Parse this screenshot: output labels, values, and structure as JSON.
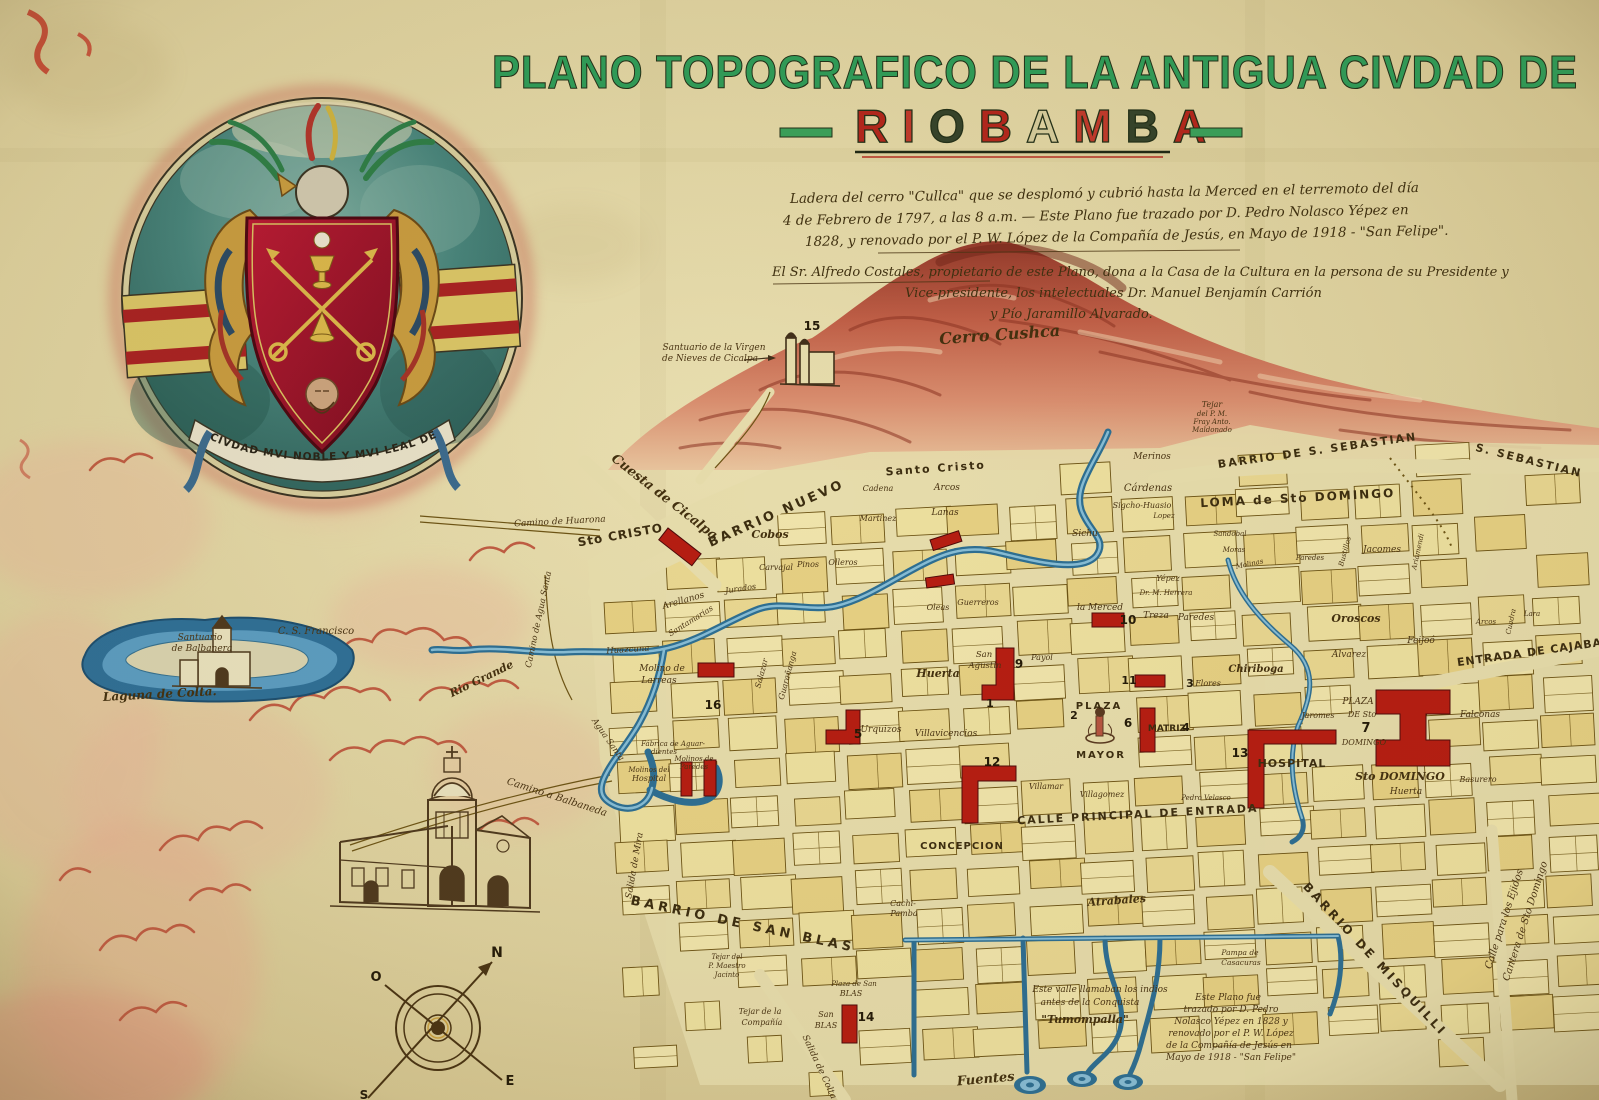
{
  "title": {
    "line1": "PLANO TOPOGRAFICO DE LA ANTIGUA CIVDAD DE",
    "line2": "RIOBAMBA",
    "letter_colors": [
      "#b3261c",
      "#c0392b",
      "#35432a",
      "#b3261c",
      "#d5cb9b",
      "#c0392b",
      "#35432a",
      "#b3261c"
    ],
    "accent_green": "#2f9c58",
    "accent_red": "#b3261c"
  },
  "coat_of_arms": {
    "motto": "CIVDAD MVI NOBLE Y MVI LEAL DE SAN PEDRO DE RIOBAMBA"
  },
  "compass": {
    "north": "N",
    "south": "S",
    "east": "E",
    "west": "O"
  },
  "map_labels": [
    {
      "t": "Ladera del cerro \"Cullca\" que se desplomó y cubrió hasta la Merced en el terremoto del día",
      "c": "note",
      "s": 13.5,
      "x": 790,
      "y": 203,
      "a": "start",
      "r": -1
    },
    {
      "t": "4 de Febrero de 1797, a las 8 a.m. — Este Plano fue trazado por D. Pedro Nolasco Yépez en",
      "c": "note",
      "s": 13.5,
      "x": 783,
      "y": 225,
      "a": "start",
      "r": -1
    },
    {
      "t": "1828, y renovado por el P. W. López de la Compañía de Jesús, en Mayo de 1918 - \"San Felipe\".",
      "c": "note",
      "s": 13.5,
      "x": 805,
      "y": 246,
      "a": "start",
      "r": -1
    },
    {
      "t": "El Sr. Alfredo Costales, propietario de este Plano, dona a la Casa de la Cultura en la persona de su Presidente y",
      "c": "note",
      "s": 13,
      "x": 772,
      "y": 276,
      "a": "start"
    },
    {
      "t": "Vice-presidente, los intelectuales Dr. Manuel Benjamín Carrión",
      "c": "note",
      "s": 13,
      "x": 905,
      "y": 297,
      "a": "start"
    },
    {
      "t": "y Pío Jaramillo Alvarado.",
      "c": "note",
      "s": 13,
      "x": 990,
      "y": 318,
      "a": "start"
    },
    {
      "t": "Cerro Cushca",
      "c": "scriptb",
      "s": 16,
      "x": 1000,
      "y": 340,
      "r": -4
    },
    {
      "t": "Santuario de la Virgen",
      "s": 9,
      "x": 714,
      "y": 350
    },
    {
      "t": "de Nieves de Cicalpa",
      "s": 9,
      "x": 710,
      "y": 361
    },
    {
      "t": "15",
      "c": "num",
      "s": 12,
      "x": 812,
      "y": 330
    },
    {
      "t": "Santuario",
      "s": 9,
      "x": 200,
      "y": 640
    },
    {
      "t": "de Balbanera",
      "s": 9,
      "x": 202,
      "y": 651
    },
    {
      "t": "C. S. Francisco",
      "s": 10,
      "x": 316,
      "y": 634
    },
    {
      "t": "Laguna de Colta.",
      "c": "scriptb",
      "s": 12,
      "x": 160,
      "y": 698,
      "r": -3
    },
    {
      "t": "Cuesta de Cicalpa",
      "c": "scriptb",
      "s": 13,
      "x": 662,
      "y": 500,
      "r": 38
    },
    {
      "t": "Camino de Huarona",
      "s": 9,
      "x": 560,
      "y": 524,
      "r": -3
    },
    {
      "t": "Sto CRISTO",
      "c": "caps",
      "s": 12,
      "x": 621,
      "y": 539,
      "r": -10,
      "sp": 1
    },
    {
      "t": "BARRIO NUEVO",
      "c": "caps",
      "s": 13,
      "x": 778,
      "y": 517,
      "r": -24,
      "sp": 3
    },
    {
      "t": "Santo Cristo",
      "c": "caps",
      "s": 11,
      "x": 936,
      "y": 472,
      "r": -4,
      "sp": 2
    },
    {
      "t": "BARRIO DE S. SEBASTIAN",
      "c": "caps",
      "s": 11,
      "x": 1318,
      "y": 454,
      "r": -8,
      "sp": 2
    },
    {
      "t": "S. SEBASTIAN",
      "c": "caps",
      "s": 11,
      "x": 1528,
      "y": 464,
      "r": 14,
      "sp": 2
    },
    {
      "t": "LOMA de Sto DOMINGO",
      "c": "caps",
      "s": 12,
      "x": 1298,
      "y": 502,
      "r": -3,
      "sp": 2
    },
    {
      "t": "ENTRADA DE CAJABA",
      "c": "caps",
      "s": 11,
      "x": 1530,
      "y": 656,
      "r": -8,
      "sp": 1
    },
    {
      "t": "CALLE PRINCIPAL DE ENTRADA",
      "c": "caps",
      "s": 11,
      "x": 1138,
      "y": 818,
      "r": -3,
      "sp": 2
    },
    {
      "t": "BARRIO DE SAN BLAS",
      "c": "caps",
      "s": 13,
      "x": 742,
      "y": 928,
      "r": 12,
      "sp": 4
    },
    {
      "t": "BARRIO DE MISQUILLI",
      "c": "caps",
      "s": 12,
      "x": 1372,
      "y": 962,
      "r": 47,
      "sp": 3
    },
    {
      "t": "Calle para los Ejidos",
      "s": 10,
      "x": 1507,
      "y": 920,
      "r": -72
    },
    {
      "t": "Cantera de Sto Domingo",
      "s": 10,
      "x": 1528,
      "y": 922,
      "r": -72
    },
    {
      "t": "Salida de Mira",
      "s": 9,
      "x": 637,
      "y": 866,
      "r": -80
    },
    {
      "t": "Salida de Colta",
      "s": 9,
      "x": 817,
      "y": 1068,
      "r": 65
    },
    {
      "t": "Camino a Balbaneda",
      "s": 10,
      "x": 556,
      "y": 800,
      "r": 18
    },
    {
      "t": "Camino de Agua Santa",
      "s": 8.5,
      "x": 541,
      "y": 620,
      "r": -78
    },
    {
      "t": "Agua Santa",
      "s": 8.5,
      "x": 606,
      "y": 741,
      "r": 55
    },
    {
      "t": "Rio Grande",
      "c": "scriptb",
      "s": 11,
      "x": 483,
      "y": 682,
      "r": -26
    },
    {
      "t": "Huazcuna",
      "s": 8.5,
      "x": 628,
      "y": 652,
      "r": -4
    },
    {
      "t": "Merinos",
      "s": 9,
      "x": 1152,
      "y": 459
    },
    {
      "t": "Cárdenas",
      "s": 10,
      "x": 1148,
      "y": 491
    },
    {
      "t": "Sigcho-Huasio",
      "s": 8,
      "x": 1142,
      "y": 508
    },
    {
      "t": "Sichu",
      "s": 9,
      "x": 1085,
      "y": 536
    },
    {
      "t": "Tejar",
      "s": 8,
      "x": 1212,
      "y": 407
    },
    {
      "t": "del P. M.",
      "s": 7,
      "x": 1212,
      "y": 416
    },
    {
      "t": "Fray Anto.",
      "s": 7,
      "x": 1212,
      "y": 424
    },
    {
      "t": "Maldonado",
      "s": 7,
      "x": 1212,
      "y": 432
    },
    {
      "t": "Lopez",
      "s": 7,
      "x": 1164,
      "y": 518
    },
    {
      "t": "Sandobal",
      "s": 7,
      "x": 1230,
      "y": 536
    },
    {
      "t": "Moras",
      "s": 7,
      "x": 1234,
      "y": 552
    },
    {
      "t": "Molinas",
      "s": 7,
      "x": 1250,
      "y": 566,
      "r": -12
    },
    {
      "t": "Paredes",
      "s": 7,
      "x": 1310,
      "y": 560
    },
    {
      "t": "Bustillos",
      "s": 7,
      "x": 1347,
      "y": 552,
      "r": -75
    },
    {
      "t": "Jacomes",
      "s": 9,
      "x": 1382,
      "y": 552
    },
    {
      "t": "Ariamendi",
      "s": 7,
      "x": 1420,
      "y": 552,
      "r": -78
    },
    {
      "t": "Oroscos",
      "c": "scriptb",
      "s": 11,
      "x": 1356,
      "y": 622
    },
    {
      "t": "Alvarez",
      "s": 9,
      "x": 1349,
      "y": 657
    },
    {
      "t": "Feijoó",
      "s": 9,
      "x": 1421,
      "y": 643
    },
    {
      "t": "Arcos",
      "s": 7,
      "x": 1486,
      "y": 624
    },
    {
      "t": "Cuadra",
      "s": 7,
      "x": 1513,
      "y": 622,
      "r": -78
    },
    {
      "t": "Lara",
      "s": 7,
      "x": 1532,
      "y": 616
    },
    {
      "t": "Falconas",
      "s": 9,
      "x": 1480,
      "y": 717
    },
    {
      "t": "PLAZA",
      "c": "caps",
      "s": 10,
      "x": 1099,
      "y": 709,
      "sp": 2
    },
    {
      "t": "MAYOR",
      "c": "caps",
      "s": 10,
      "x": 1101,
      "y": 758,
      "sp": 2
    },
    {
      "t": "MATRIZ",
      "c": "caps",
      "s": 9,
      "x": 1167,
      "y": 731
    },
    {
      "t": "4",
      "c": "num",
      "s": 11,
      "x": 1186,
      "y": 731
    },
    {
      "t": "6",
      "c": "num",
      "s": 12,
      "x": 1128,
      "y": 727
    },
    {
      "t": "1",
      "c": "num",
      "s": 11,
      "x": 990,
      "y": 707
    },
    {
      "t": "2",
      "c": "num",
      "s": 11,
      "x": 1074,
      "y": 719
    },
    {
      "t": "San",
      "s": 8.5,
      "x": 984,
      "y": 657
    },
    {
      "t": "Agustin",
      "s": 8.5,
      "x": 985,
      "y": 668
    },
    {
      "t": "9",
      "c": "num",
      "s": 12,
      "x": 1019,
      "y": 668
    },
    {
      "t": "Huerta",
      "c": "scriptb",
      "s": 11,
      "x": 938,
      "y": 677
    },
    {
      "t": "la Merced",
      "s": 9,
      "x": 1100,
      "y": 610
    },
    {
      "t": "10",
      "c": "num",
      "s": 12,
      "x": 1128,
      "y": 624
    },
    {
      "t": "Treza",
      "s": 9,
      "x": 1156,
      "y": 618
    },
    {
      "t": "Paredes",
      "s": 9,
      "x": 1196,
      "y": 620
    },
    {
      "t": "Yépez",
      "s": 8,
      "x": 1168,
      "y": 581
    },
    {
      "t": "Dr. M. Herrera",
      "s": 7,
      "x": 1166,
      "y": 595
    },
    {
      "t": "Chiriboga",
      "c": "scriptb",
      "s": 10,
      "x": 1256,
      "y": 672
    },
    {
      "t": "Flores",
      "s": 8,
      "x": 1208,
      "y": 686
    },
    {
      "t": "3",
      "c": "num",
      "s": 11,
      "x": 1190,
      "y": 687
    },
    {
      "t": "11",
      "c": "num",
      "s": 11,
      "x": 1129,
      "y": 684
    },
    {
      "t": "Urquizos",
      "s": 9,
      "x": 881,
      "y": 732
    },
    {
      "t": "Villavicencios",
      "s": 9,
      "x": 946,
      "y": 736
    },
    {
      "t": "5",
      "c": "num",
      "s": 12,
      "x": 858,
      "y": 738
    },
    {
      "t": "12",
      "c": "num",
      "s": 12,
      "x": 992,
      "y": 766
    },
    {
      "t": "Payol",
      "s": 8,
      "x": 1042,
      "y": 660
    },
    {
      "t": "Villamar",
      "s": 8,
      "x": 1046,
      "y": 789
    },
    {
      "t": "Villagomez",
      "s": 8,
      "x": 1102,
      "y": 797
    },
    {
      "t": "Pedro Velasco",
      "s": 7,
      "x": 1206,
      "y": 800
    },
    {
      "t": "Jaromes",
      "s": 8,
      "x": 1318,
      "y": 718
    },
    {
      "t": "HOSPITAL",
      "c": "caps",
      "s": 11,
      "x": 1292,
      "y": 767,
      "sp": 1
    },
    {
      "t": "13",
      "c": "num",
      "s": 12,
      "x": 1240,
      "y": 757
    },
    {
      "t": "PLAZA",
      "s": 9,
      "x": 1358,
      "y": 704
    },
    {
      "t": "DE Sto",
      "s": 8,
      "x": 1362,
      "y": 717
    },
    {
      "t": "7",
      "c": "num",
      "s": 13,
      "x": 1366,
      "y": 732
    },
    {
      "t": "DOMINGO",
      "s": 8,
      "x": 1364,
      "y": 745
    },
    {
      "t": "Sto DOMINGO",
      "c": "scriptb",
      "s": 11,
      "x": 1400,
      "y": 780
    },
    {
      "t": "Huerta",
      "s": 9,
      "x": 1406,
      "y": 794
    },
    {
      "t": "Basurero",
      "s": 8,
      "x": 1478,
      "y": 782
    },
    {
      "t": "Cobos",
      "c": "scriptb",
      "s": 11,
      "x": 770,
      "y": 538
    },
    {
      "t": "Carvajal",
      "s": 8,
      "x": 776,
      "y": 570
    },
    {
      "t": "Pinos",
      "s": 8,
      "x": 808,
      "y": 567
    },
    {
      "t": "Olleros",
      "s": 8,
      "x": 843,
      "y": 565
    },
    {
      "t": "Cadena",
      "s": 8,
      "x": 878,
      "y": 491
    },
    {
      "t": "Martinez",
      "s": 8,
      "x": 878,
      "y": 521
    },
    {
      "t": "Arcos",
      "s": 9,
      "x": 947,
      "y": 490
    },
    {
      "t": "Lanas",
      "s": 9,
      "x": 945,
      "y": 515
    },
    {
      "t": "Arellanos",
      "s": 9,
      "x": 684,
      "y": 603,
      "r": -16
    },
    {
      "t": "Jurados",
      "s": 8,
      "x": 741,
      "y": 591,
      "r": -8
    },
    {
      "t": "Santamarias",
      "s": 8,
      "x": 692,
      "y": 623,
      "r": -32
    },
    {
      "t": "Salazar",
      "s": 8,
      "x": 764,
      "y": 674,
      "r": -75
    },
    {
      "t": "Guarañanga",
      "s": 8,
      "x": 790,
      "y": 676,
      "r": -75
    },
    {
      "t": "Oleas",
      "s": 8,
      "x": 938,
      "y": 610
    },
    {
      "t": "Guerreros",
      "s": 8,
      "x": 978,
      "y": 605
    },
    {
      "t": "16",
      "c": "num",
      "s": 12,
      "x": 713,
      "y": 709
    },
    {
      "t": "Molino de",
      "s": 9,
      "x": 662,
      "y": 671
    },
    {
      "t": "Larreas",
      "s": 9,
      "x": 659,
      "y": 683
    },
    {
      "t": "Fábrica de Aguar-",
      "s": 7,
      "x": 673,
      "y": 746
    },
    {
      "t": "dientes",
      "s": 7,
      "x": 664,
      "y": 754
    },
    {
      "t": "Molinos del",
      "s": 7,
      "x": 649,
      "y": 772
    },
    {
      "t": "Hospital",
      "s": 8,
      "x": 649,
      "y": 781
    },
    {
      "t": "Molinos de",
      "s": 7,
      "x": 694,
      "y": 761
    },
    {
      "t": "Paredes",
      "s": 7,
      "x": 694,
      "y": 769
    },
    {
      "t": "CONCEPCION",
      "c": "caps",
      "s": 10,
      "x": 962,
      "y": 849,
      "sp": 1
    },
    {
      "t": "Cachi-",
      "s": 8,
      "x": 903,
      "y": 906
    },
    {
      "t": "Pamba",
      "s": 8,
      "x": 904,
      "y": 916
    },
    {
      "t": "Atrabales",
      "c": "scriptb",
      "s": 11,
      "x": 1117,
      "y": 904,
      "r": -4
    },
    {
      "t": "Plaza de San",
      "s": 7,
      "x": 854,
      "y": 986
    },
    {
      "t": "BLAS",
      "s": 8,
      "x": 851,
      "y": 996
    },
    {
      "t": "San",
      "s": 8,
      "x": 826,
      "y": 1017
    },
    {
      "t": "BLAS",
      "s": 8,
      "x": 826,
      "y": 1028
    },
    {
      "t": "14",
      "c": "num",
      "s": 12,
      "x": 866,
      "y": 1021
    },
    {
      "t": "Tejar de la",
      "s": 8,
      "x": 760,
      "y": 1014
    },
    {
      "t": "Compañía",
      "s": 8,
      "x": 762,
      "y": 1025
    },
    {
      "t": "Tejar del",
      "s": 7,
      "x": 727,
      "y": 959
    },
    {
      "t": "P. Maestro",
      "s": 7,
      "x": 727,
      "y": 968
    },
    {
      "t": "Jacinto",
      "s": 7,
      "x": 727,
      "y": 977
    },
    {
      "t": "Fuentes",
      "c": "scriptb",
      "s": 13,
      "x": 986,
      "y": 1083,
      "r": -5
    },
    {
      "t": "Este valle llamaban los indios",
      "s": 9,
      "x": 1100,
      "y": 992
    },
    {
      "t": "antes de la Conquista",
      "s": 9,
      "x": 1090,
      "y": 1005
    },
    {
      "t": "\"Tumompalla\"",
      "c": "scriptb",
      "s": 11,
      "x": 1085,
      "y": 1023
    },
    {
      "t": "Este Plano fue",
      "s": 9,
      "x": 1228,
      "y": 1000
    },
    {
      "t": "trazado por D. Pedro",
      "s": 9,
      "x": 1231,
      "y": 1012
    },
    {
      "t": "Nolasco Yépez en 1828 y",
      "s": 9,
      "x": 1231,
      "y": 1024
    },
    {
      "t": "renovado por el P. W. López",
      "s": 9,
      "x": 1231,
      "y": 1036
    },
    {
      "t": "de la Compañía de Jesús en",
      "s": 9,
      "x": 1229,
      "y": 1048
    },
    {
      "t": "Mayo de 1918 - \"San Felipe\"",
      "s": 9,
      "x": 1231,
      "y": 1060
    },
    {
      "t": "Pampa de",
      "s": 7.5,
      "x": 1240,
      "y": 955
    },
    {
      "t": "Casacuras",
      "s": 7.5,
      "x": 1241,
      "y": 965
    },
    {
      "t": "N",
      "c": "num",
      "s": 14,
      "x": 497,
      "y": 957
    },
    {
      "t": "O",
      "c": "num",
      "s": 13,
      "x": 376,
      "y": 981
    },
    {
      "t": "E",
      "c": "num",
      "s": 13,
      "x": 510,
      "y": 1085
    },
    {
      "t": "S",
      "c": "num",
      "s": 12,
      "x": 364,
      "y": 1099
    }
  ]
}
